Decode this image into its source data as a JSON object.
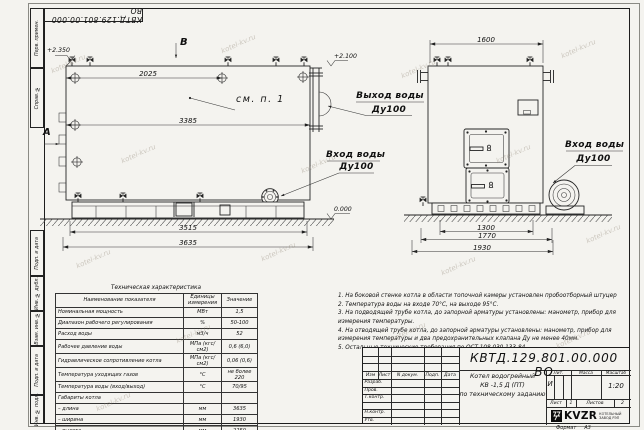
{
  "watermark": "kotel-kv.ru",
  "stamp_top": "КВТД.129.801.00.000  ВО",
  "margin_labels": [
    "Перв. примен.",
    "Справ. №",
    "Подп. и дата",
    "Инв. № дубл.",
    "Взам. инв. №",
    "Подп. и дата",
    "Инв. № подл."
  ],
  "format_label": "Формат",
  "format_value": "А3",
  "front_view": {
    "view_b": "В",
    "view_a": "А",
    "elev_top": "+2.350",
    "elev_pipe": "+2.100",
    "elev_zero": "0.000",
    "see_note": "см. п. 1",
    "dim_top": "2025",
    "dim_mid": "3385",
    "dim_base": "3515",
    "dim_overall": "3635",
    "outlet_line1": "Выход воды",
    "outlet_line2": "Ду100",
    "inlet_line1": "Вход воды",
    "inlet_line2": "Ду100"
  },
  "side_view": {
    "dim_top": "1600",
    "dim_b1": "1300",
    "dim_b2": "1770",
    "dim_b3": "1930",
    "inlet_line1": "Вход воды",
    "inlet_line2": "Ду100"
  },
  "tech_table": {
    "title": "Техническая характеристика",
    "headers": [
      "Наименование показателя",
      "Единицы измерения",
      "Значение"
    ],
    "rows": [
      {
        "name": "Номинальная мощность",
        "unit": "МВт",
        "value": "1,5"
      },
      {
        "name": "Диапазон рабочего регулирования",
        "unit": "%",
        "value": "50-100"
      },
      {
        "name": "Расход воды",
        "unit": "м3/ч",
        "value": "52"
      },
      {
        "name": "Рабочее давление воды",
        "unit": "МПа (кгс/см2)",
        "value": "0,6 (6,0)"
      },
      {
        "name": "Гидравлическое сопротивление котла",
        "unit": "МПа (кгс/см2)",
        "value": "0,06 (0,6)"
      },
      {
        "name": "Температура уходящих газов",
        "unit": "°С",
        "value": "не более 220"
      },
      {
        "name": "Температура воды (вход/выход)",
        "unit": "°С",
        "value": "70/95"
      },
      {
        "name": "Габариты котла",
        "unit": "",
        "value": ""
      },
      {
        "name": "–  длина",
        "unit": "мм",
        "value": "3635"
      },
      {
        "name": "–  ширина",
        "unit": "мм",
        "value": "1930"
      },
      {
        "name": "–  высота",
        "unit": "мм",
        "value": "2250"
      }
    ]
  },
  "notes": [
    "1.  На боковой стенке котла в области топочной камеры установлен пробоотборный штуцер",
    "2.  Температура воды на входе 70°С, на выходе 95°С.",
    "3.  На подводящей трубе котла, до запорной арматуры установлены: манометр, прибор для измерения температуры.",
    "4.  На отводящей трубе котла, до запорной арматуры установлены: манометр, прибор для измерения температуры и два предохранительных клапана Ду не менее 40мм.",
    "5.  Остальные технические требования по ОСТ 108.030.133-84."
  ],
  "title_block": {
    "doc_number": "КВТД.129.801.00.000  ВО",
    "product_line1": "Котел водогрейный",
    "product_line2": "КВ -1,5  Д  (ПТ)",
    "product_line3": "по техническому заданию",
    "col_headers": [
      "Изм",
      "Лист",
      "N докум.",
      "Подп.",
      "Дата"
    ],
    "row_labels": [
      "Разраб.",
      "Пров.",
      "Т.контр.",
      "Н.контр.",
      "Утв."
    ],
    "lit_label": "Лит.",
    "mass_label": "Масса",
    "scale_label": "Масштаб",
    "lit_value": "И",
    "scale_value": "1:20",
    "sheet_label": "Лист",
    "sheet_number": "1",
    "sheets_label": "Листов",
    "sheets_total": "2",
    "logo_text": "KVZR",
    "logo_sub1": "КОТЕЛЬНЫЙ",
    "logo_sub2": "ЗАВОД РЭП"
  }
}
